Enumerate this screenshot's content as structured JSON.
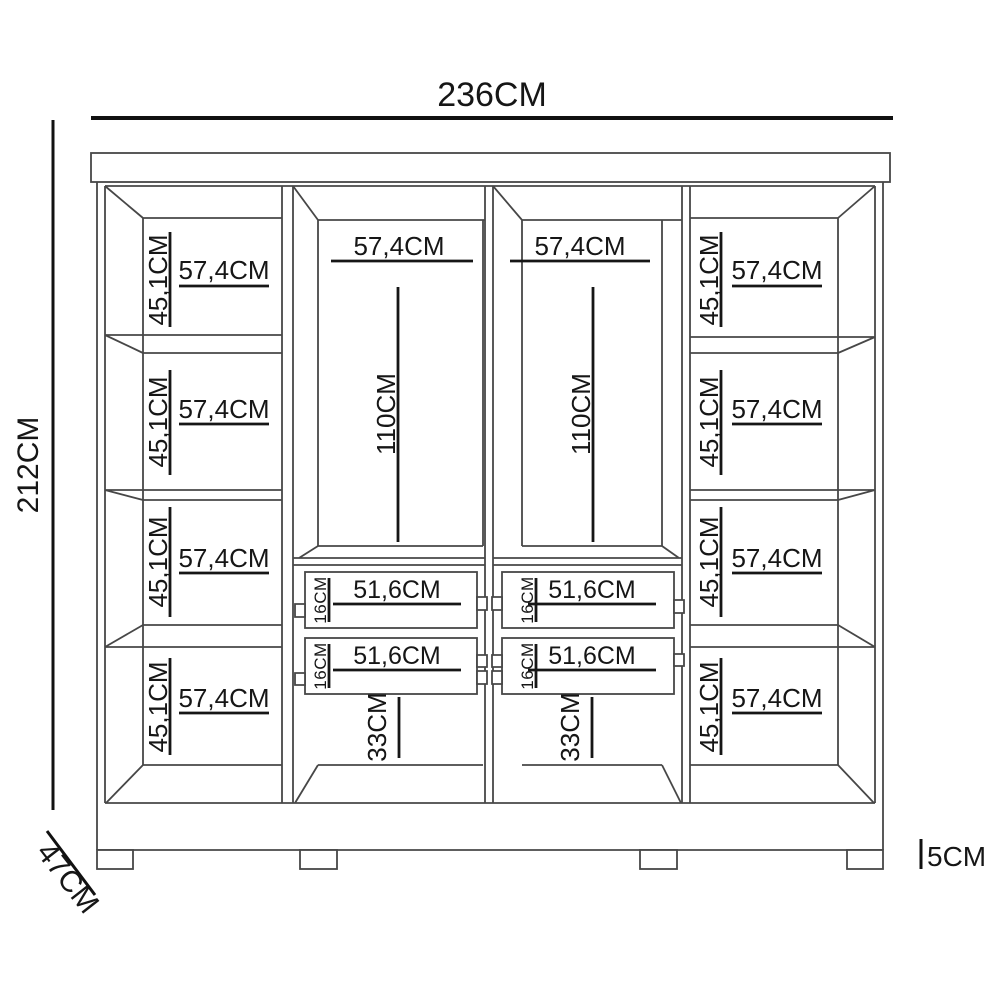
{
  "dimensions": {
    "total_width": "236CM",
    "total_height": "212CM",
    "depth": "47CM",
    "base_height": "5CM"
  },
  "left_column": {
    "compartments": [
      {
        "height": "45,1CM",
        "width": "57,4CM"
      },
      {
        "height": "45,1CM",
        "width": "57,4CM"
      },
      {
        "height": "45,1CM",
        "width": "57,4CM"
      },
      {
        "height": "45,1CM",
        "width": "57,4CM"
      }
    ]
  },
  "center_left_column": {
    "width": "57,4CM",
    "hanging_height": "110CM",
    "drawers": [
      {
        "height": "16CM",
        "width": "51,6CM"
      },
      {
        "height": "16CM",
        "width": "51,6CM"
      }
    ],
    "bottom_height": "33CM"
  },
  "center_right_column": {
    "width": "57,4CM",
    "hanging_height": "110CM",
    "drawers": [
      {
        "height": "16CM",
        "width": "51,6CM"
      },
      {
        "height": "16CM",
        "width": "51,6CM"
      }
    ],
    "bottom_height": "33CM"
  },
  "right_column": {
    "compartments": [
      {
        "height": "45,1CM",
        "width": "57,4CM"
      },
      {
        "height": "45,1CM",
        "width": "57,4CM"
      },
      {
        "height": "45,1CM",
        "width": "57,4CM"
      },
      {
        "height": "45,1CM",
        "width": "57,4CM"
      }
    ]
  }
}
